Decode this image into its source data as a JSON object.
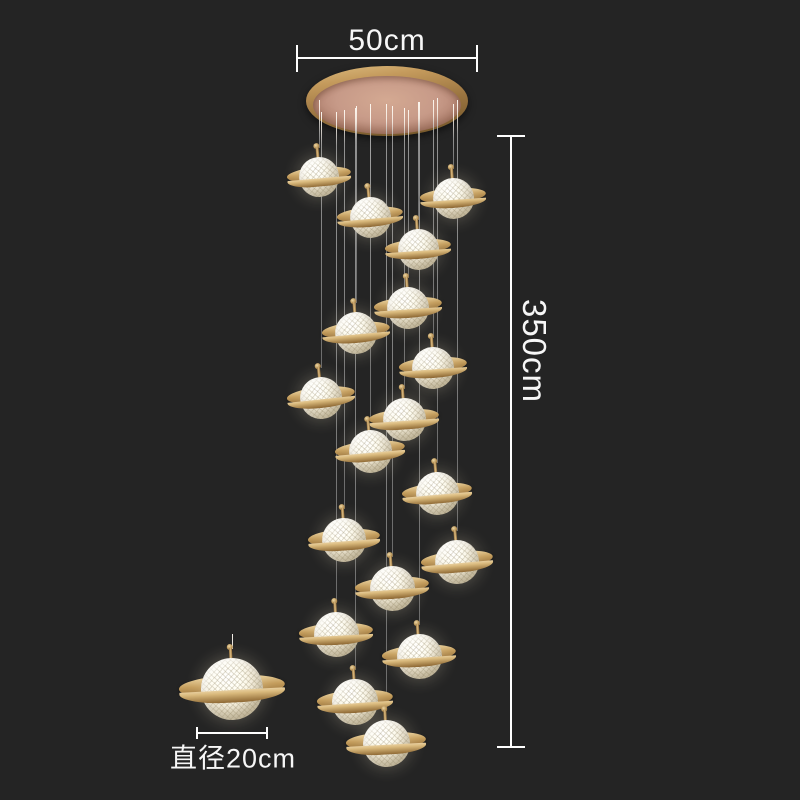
{
  "image_type": "product photo of a saturn-style multi-globe staircase chandelier on dark background with dimension callouts",
  "annotations": {
    "canopy_width": {
      "label": "50cm"
    },
    "drop_height": {
      "label": "350cm"
    },
    "pendant_diameter": {
      "label": "直径20cm"
    }
  },
  "colors": {
    "background": "#242424",
    "annotation_text": "#f7f7f7",
    "dimension_line": "#ffffff",
    "ring_gold": "#c49d5c",
    "canopy_face_rose": "#c79a88",
    "glass_white": "#fdf8ea",
    "wire_gray": "#8a8a8a"
  },
  "lamp": {
    "pendant_count_cluster": 18,
    "canopy": {
      "x": 387,
      "y": 101,
      "rx": 81,
      "ry": 35,
      "face_rx": 74,
      "face_ry": 29
    },
    "pendants": [
      {
        "x": 319,
        "y": 177,
        "d": 40,
        "ringW": 64,
        "ringH": 15,
        "tilt": -5,
        "wireTop": 100
      },
      {
        "x": 453,
        "y": 198,
        "d": 41,
        "ringW": 66,
        "ringH": 15,
        "tilt": -4,
        "wireTop": 104
      },
      {
        "x": 370,
        "y": 217,
        "d": 41,
        "ringW": 66,
        "ringH": 15,
        "tilt": -5,
        "wireTop": 108
      },
      {
        "x": 418,
        "y": 249,
        "d": 41,
        "ringW": 66,
        "ringH": 15,
        "tilt": -4,
        "wireTop": 102
      },
      {
        "x": 408,
        "y": 308,
        "d": 42,
        "ringW": 68,
        "ringH": 16,
        "tilt": -4,
        "wireTop": 110
      },
      {
        "x": 356,
        "y": 333,
        "d": 42,
        "ringW": 68,
        "ringH": 16,
        "tilt": -5,
        "wireTop": 106
      },
      {
        "x": 433,
        "y": 368,
        "d": 42,
        "ringW": 68,
        "ringH": 16,
        "tilt": -4,
        "wireTop": 100
      },
      {
        "x": 321,
        "y": 398,
        "d": 42,
        "ringW": 68,
        "ringH": 16,
        "tilt": -6,
        "wireTop": 112
      },
      {
        "x": 404,
        "y": 419,
        "d": 43,
        "ringW": 70,
        "ringH": 16,
        "tilt": -4,
        "wireTop": 108
      },
      {
        "x": 370,
        "y": 451,
        "d": 43,
        "ringW": 70,
        "ringH": 16,
        "tilt": -5,
        "wireTop": 104
      },
      {
        "x": 437,
        "y": 493,
        "d": 43,
        "ringW": 70,
        "ringH": 16,
        "tilt": -5,
        "wireTop": 98
      },
      {
        "x": 344,
        "y": 540,
        "d": 44,
        "ringW": 72,
        "ringH": 17,
        "tilt": -4,
        "wireTop": 110
      },
      {
        "x": 457,
        "y": 562,
        "d": 44,
        "ringW": 72,
        "ringH": 17,
        "tilt": -5,
        "wireTop": 100
      },
      {
        "x": 392,
        "y": 588,
        "d": 45,
        "ringW": 74,
        "ringH": 17,
        "tilt": -4,
        "wireTop": 106
      },
      {
        "x": 336,
        "y": 634,
        "d": 45,
        "ringW": 74,
        "ringH": 17,
        "tilt": -3,
        "wireTop": 112
      },
      {
        "x": 419,
        "y": 656,
        "d": 45,
        "ringW": 74,
        "ringH": 17,
        "tilt": -4,
        "wireTop": 102
      },
      {
        "x": 355,
        "y": 702,
        "d": 46,
        "ringW": 76,
        "ringH": 18,
        "tilt": -4,
        "wireTop": 108
      },
      {
        "x": 386,
        "y": 743,
        "d": 47,
        "ringW": 80,
        "ringH": 18,
        "tilt": -3,
        "wireTop": 104
      }
    ],
    "detail_pendant": {
      "x": 232,
      "y": 689,
      "d": 62,
      "ringW": 106,
      "ringH": 23,
      "tilt": -3,
      "wireTop": 634
    }
  },
  "dimension_geometry": {
    "top_line": {
      "x1": 297,
      "x2": 477,
      "y": 57,
      "tick_h": 27
    },
    "right_line": {
      "x": 510,
      "y1": 136,
      "y2": 747,
      "tick_w": 28
    },
    "detail_line": {
      "x1": 197,
      "x2": 267,
      "y": 732,
      "tick_h": 12
    }
  }
}
